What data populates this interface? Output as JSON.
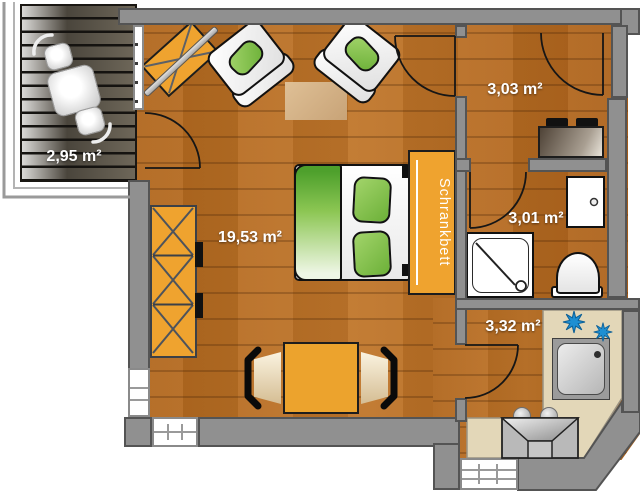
{
  "floorplan": {
    "areas": {
      "balcony": "2,95 m²",
      "living_room": "19,53 m²",
      "hallway": "3,03 m²",
      "bathroom": "3,01 m²",
      "kitchen": "3,32 m²"
    },
    "furniture": {
      "wall_bed_label": "Schrankbett"
    },
    "colors": {
      "floor_wood": "#b4671e",
      "wall_gray": "#909090",
      "furniture_orange": "#efa32f",
      "textile_green": "#7fc241",
      "counter_beige": "#e3d7b8",
      "deck_dark": "#45403a",
      "burner_blue": "#1e8fd2",
      "label_text": "#ffffff"
    }
  }
}
